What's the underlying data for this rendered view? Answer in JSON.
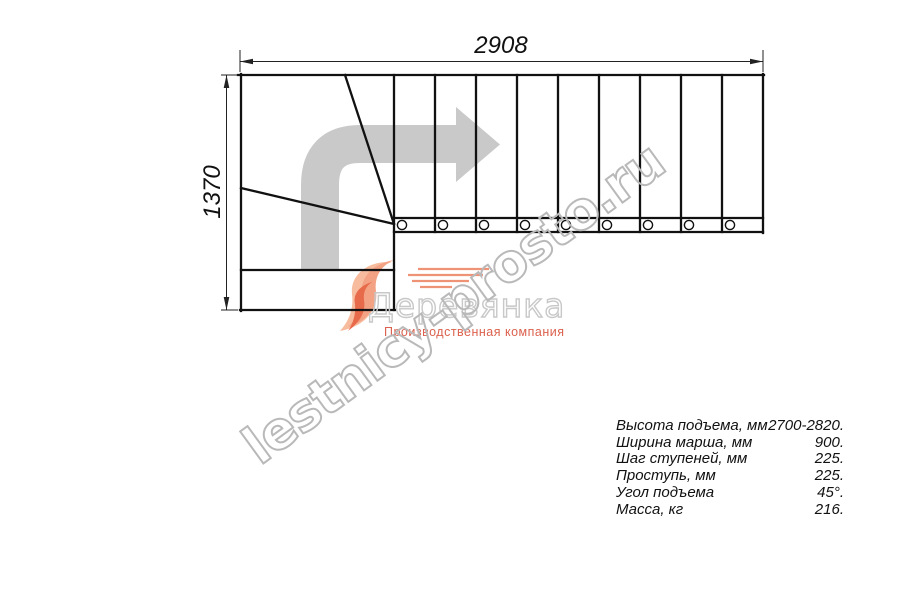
{
  "drawing": {
    "dim_width": "2908",
    "dim_height": "1370"
  },
  "watermark": {
    "text": "lestnicy-prosto.ru"
  },
  "logo": {
    "name": "Деревянка",
    "subtitle": "Производственная компания"
  },
  "specs": {
    "rows": [
      {
        "label": "Высота подъема, мм",
        "value": "2700-2820."
      },
      {
        "label": "Ширина марша, мм",
        "value": "900."
      },
      {
        "label": "Шаг ступеней, мм",
        "value": "225."
      },
      {
        "label": "Проступь, мм",
        "value": "225."
      },
      {
        "label": "Угол подъема",
        "value": "45°."
      },
      {
        "label": "Масса, кг",
        "value": "216."
      }
    ]
  },
  "colors": {
    "line": "#111111",
    "direction_arrow_gray": "#c9c9c9",
    "watermark_gray": "#b9b9b9",
    "logo_accent": "#dc614e"
  },
  "icons": {
    "direction_arrow": "curved-right-arrow",
    "logo_swoosh": "orange-swoosh"
  }
}
